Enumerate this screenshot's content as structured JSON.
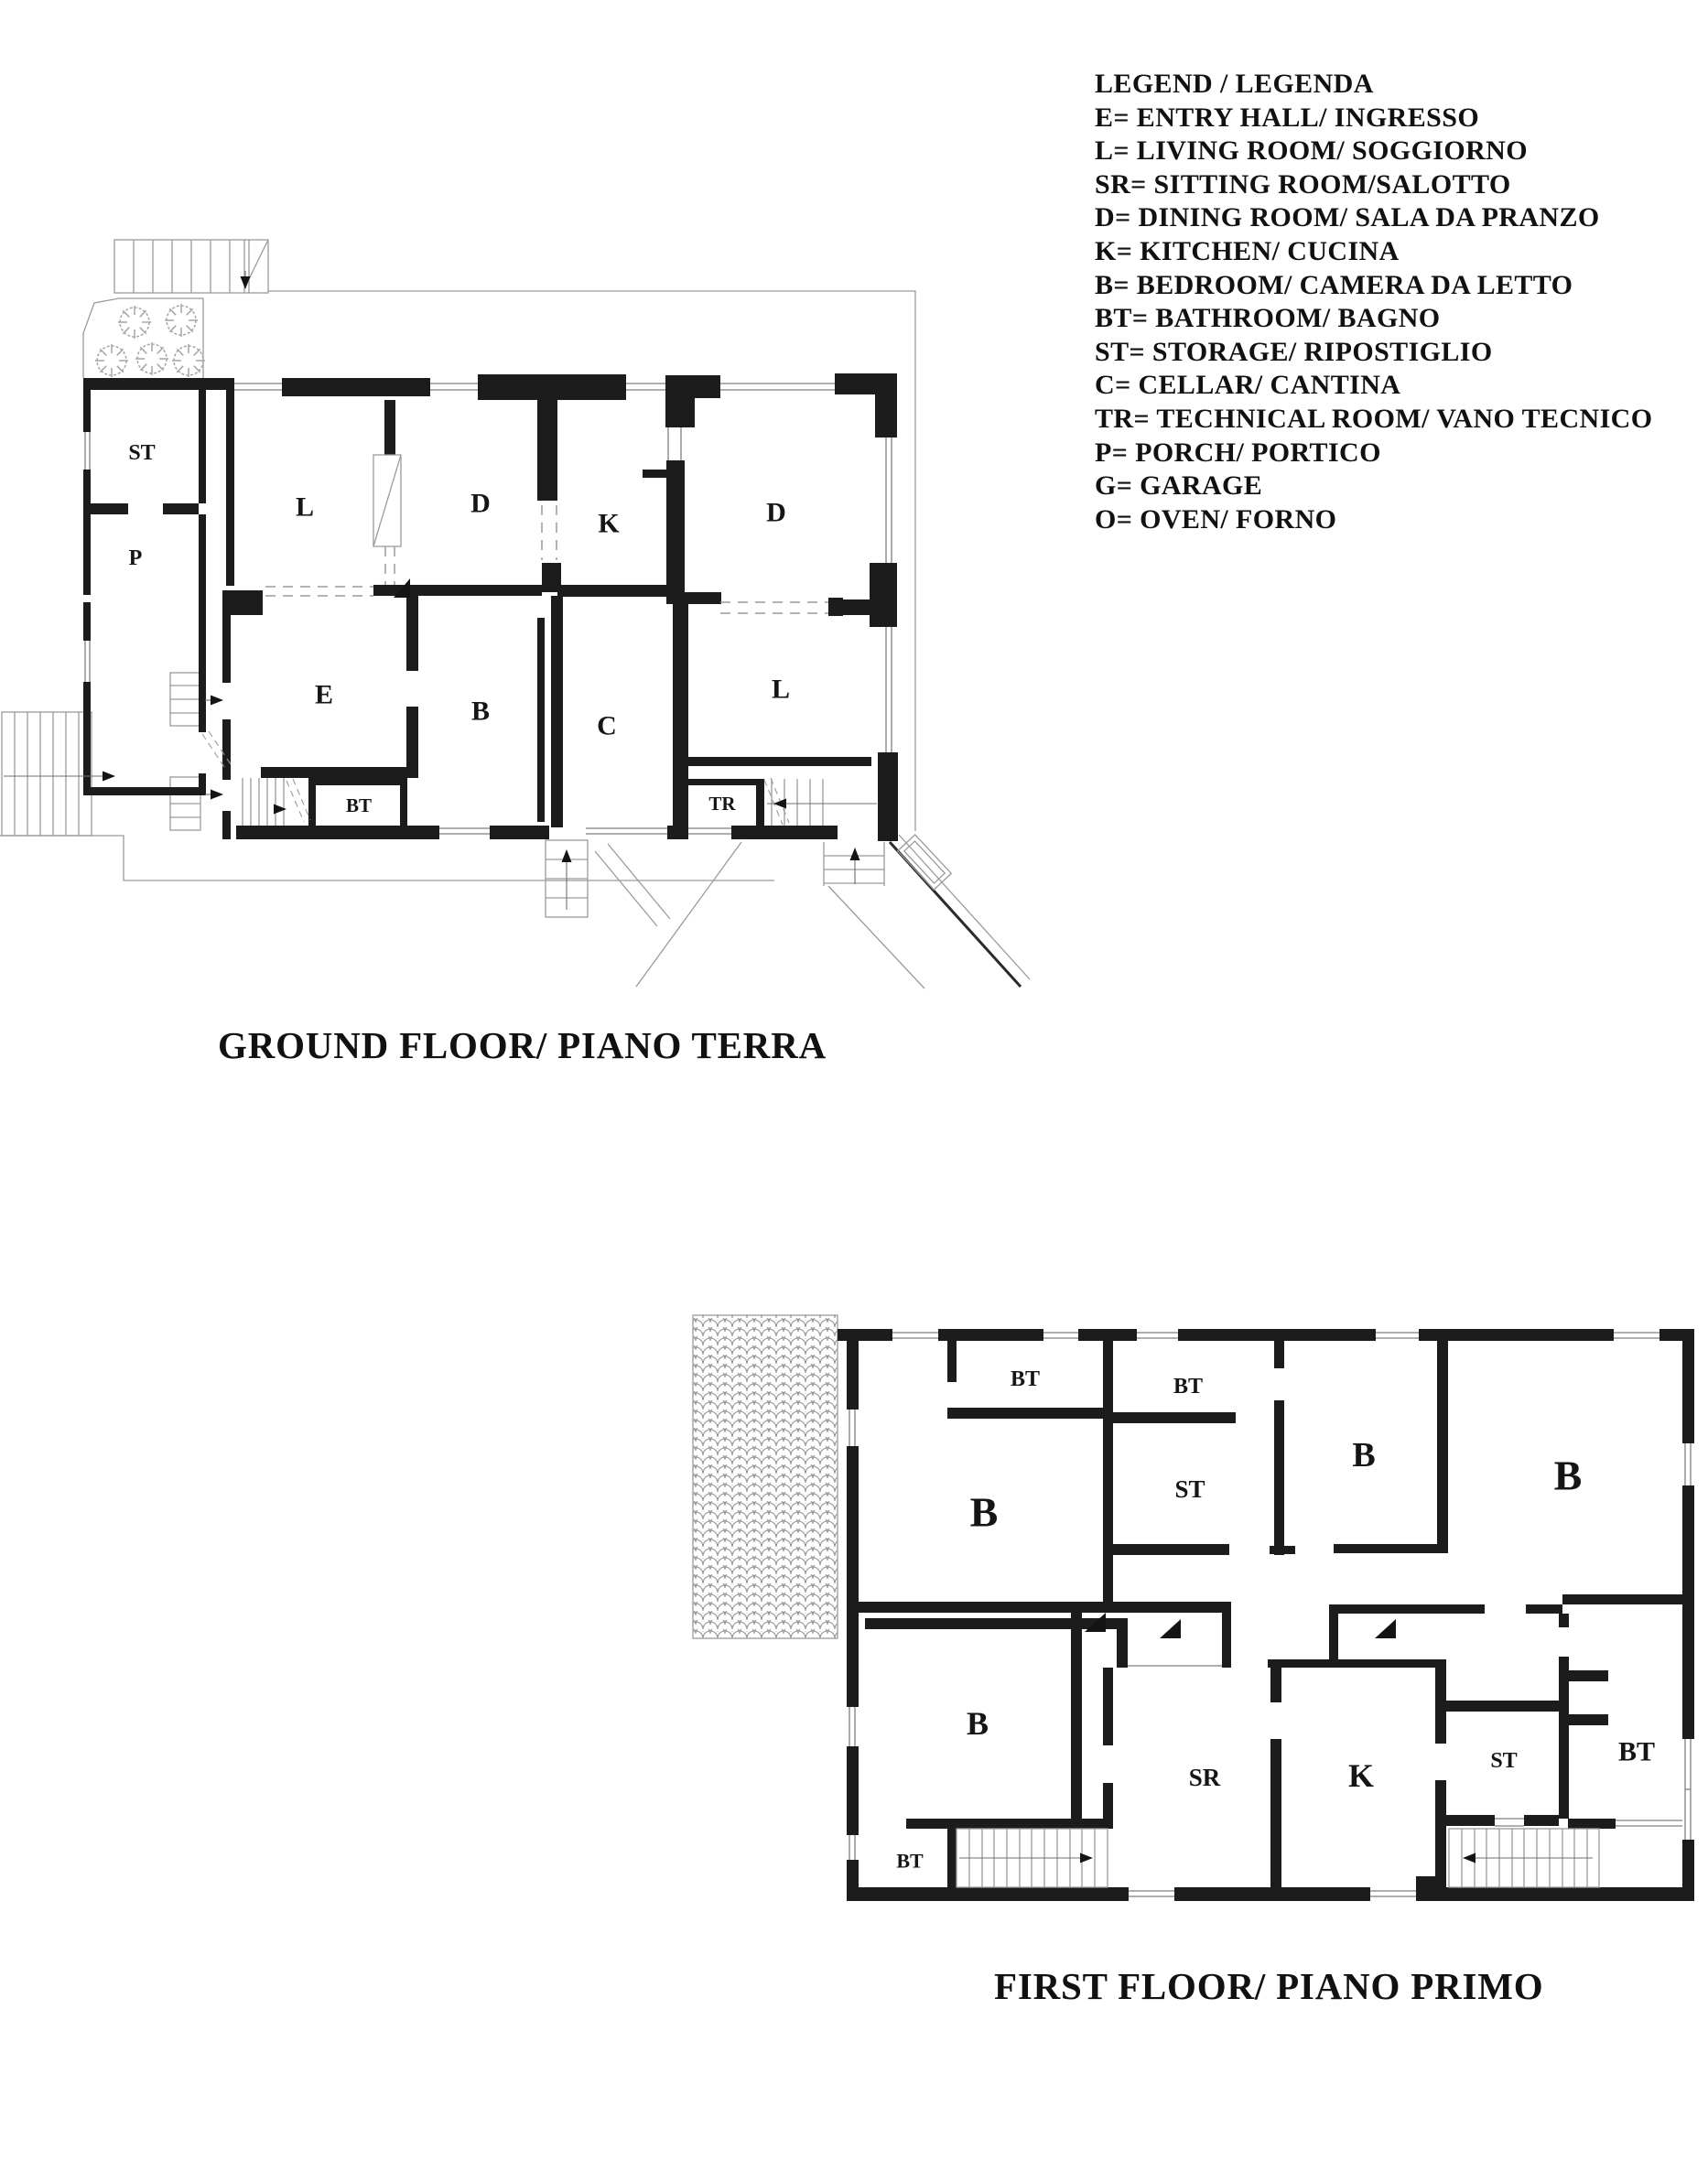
{
  "legend": {
    "title": "LEGEND / LEGENDA",
    "items": [
      "E= ENTRY HALL/ INGRESSO",
      "L= LIVING ROOM/ SOGGIORNO",
      "SR= SITTING ROOM/SALOTTO",
      "D= DINING ROOM/ SALA DA PRANZO",
      "K= KITCHEN/ CUCINA",
      "B= BEDROOM/ CAMERA DA LETTO",
      "BT= BATHROOM/ BAGNO",
      "ST= STORAGE/ RIPOSTIGLIO",
      "C= CELLAR/ CANTINA",
      "TR= TECHNICAL ROOM/ VANO TECNICO",
      "P= PORCH/ PORTICO",
      "G= GARAGE",
      "O= OVEN/ FORNO"
    ]
  },
  "ground_floor": {
    "title": "GROUND FLOOR/ PIANO TERRA",
    "rooms": {
      "st": "ST",
      "p": "P",
      "l1": "L",
      "d1": "D",
      "k": "K",
      "d2": "D",
      "e": "E",
      "b": "B",
      "c": "C",
      "l2": "L",
      "bt": "BT",
      "tr": "TR"
    }
  },
  "first_floor": {
    "title": "FIRST FLOOR/ PIANO PRIMO",
    "rooms": {
      "bt1": "BT",
      "bt2": "BT",
      "b1": "B",
      "st1": "ST",
      "b2": "B",
      "b3": "B",
      "b4": "B",
      "sr": "SR",
      "k": "K",
      "st2": "ST",
      "bt3": "BT",
      "bt4": "BT"
    }
  },
  "colors": {
    "wall": "#1c1c1c",
    "thin_line": "#9a9a9a",
    "text": "#151515",
    "background": "#ffffff"
  }
}
